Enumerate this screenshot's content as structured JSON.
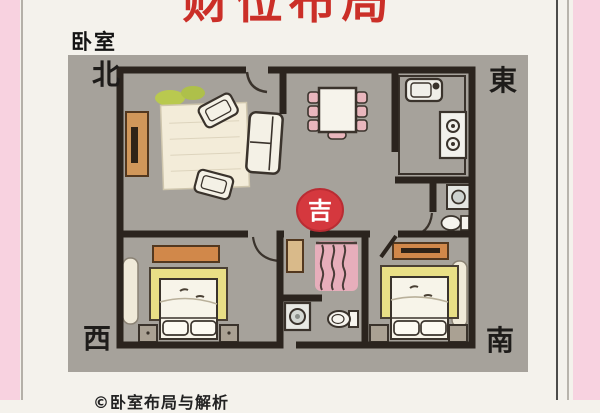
{
  "header": {
    "title": "财位布局",
    "corner_label": "卧室"
  },
  "compass": {
    "north": "北",
    "east": "東",
    "west": "西",
    "south": "南"
  },
  "plan": {
    "auspicious_badge": "吉"
  },
  "footer": {
    "caption": "©卧室布局与解析"
  },
  "colors": {
    "title_red": "#cb2f28",
    "badge_red": "#d5383e",
    "pink_frame": "#f8d2e0",
    "plan_bg": "#a6a29b",
    "wall": "#2b241e",
    "furniture_wood": "#d1884a",
    "bed_yellow": "#e9df86",
    "chair_pink": "#e9b6bd",
    "plant_green": "#b9c94f"
  }
}
